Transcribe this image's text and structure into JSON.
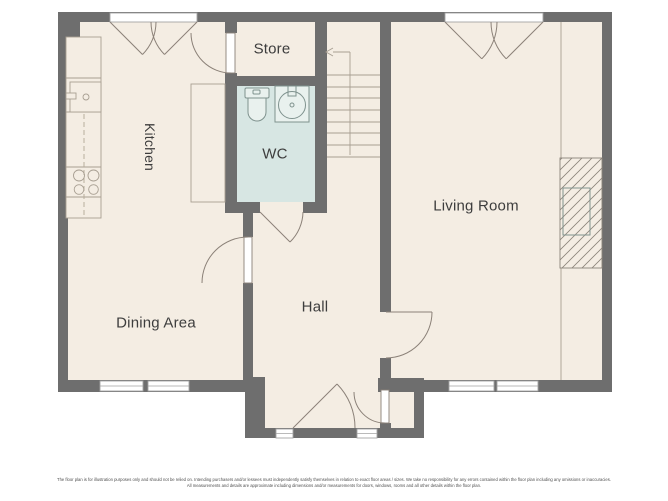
{
  "plan": {
    "rooms": {
      "kitchen": {
        "label": "Kitchen"
      },
      "store": {
        "label": "Store"
      },
      "wc": {
        "label": "WC"
      },
      "living_room": {
        "label": "Living Room"
      },
      "dining_area": {
        "label": "Dining Area"
      },
      "hall": {
        "label": "Hall"
      }
    },
    "stairs": {
      "direction_arrow": "left"
    },
    "colors": {
      "wall": "#6e6e6e",
      "floor": "#f4ede3",
      "wc_floor": "#d7e6e3",
      "label_text": "#3d3d3d",
      "door_line": "#8b8178",
      "window_border": "#a3a3a3",
      "fixture_line": "#7f928e",
      "unit_line": "#a89f92"
    }
  },
  "footer": {
    "disclaimer_line1": "The floor plan is for illustration purposes only and should not be relied on. Intending purchasers and/or lessees must independently satisfy themselves in relation to exact floor areas / sizes. We take no responsibility for any errors contained within the floor plan including any omissions or inaccuracies.",
    "disclaimer_line2": "All measurements and details are approximate including dimensions and/or measurements for doors, windows, rooms and all other details within the floor plan."
  }
}
